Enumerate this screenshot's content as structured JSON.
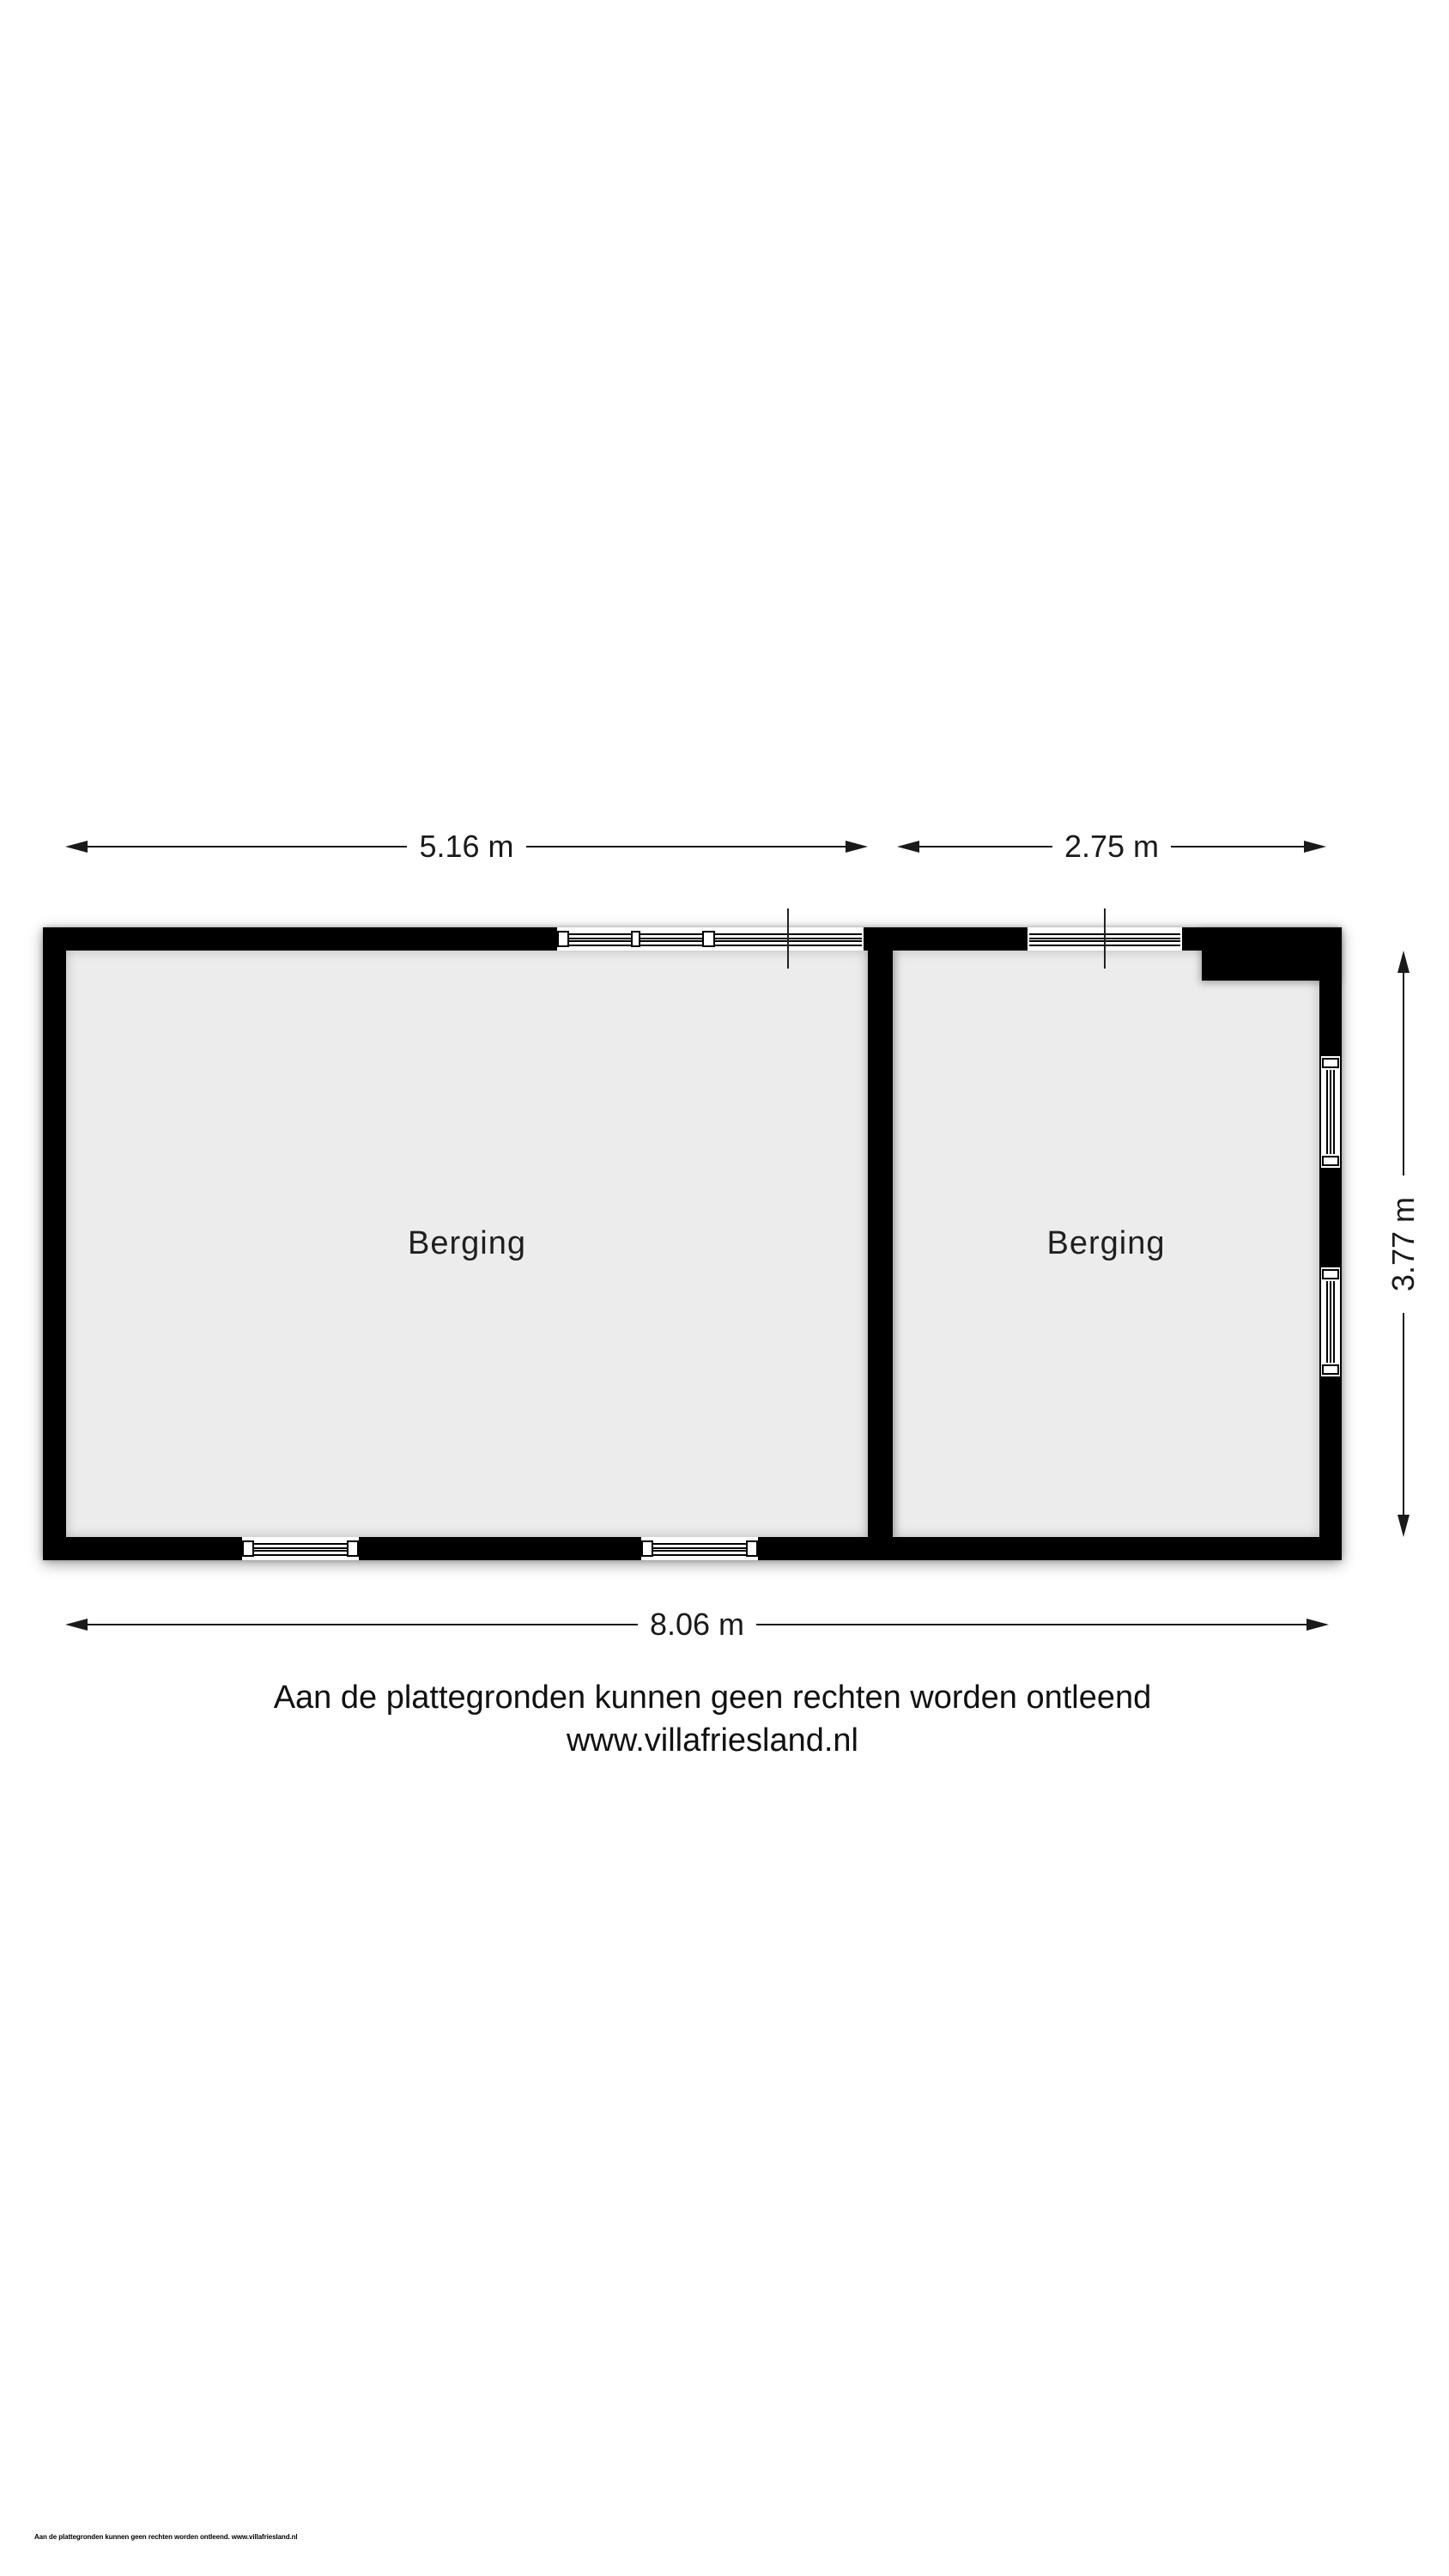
{
  "floorplan": {
    "rooms": [
      {
        "label": "Berging"
      },
      {
        "label": "Berging"
      }
    ],
    "dimensions": {
      "top_left": "5.16 m",
      "top_right": "2.75 m",
      "bottom": "8.06 m",
      "right": "3.77 m"
    }
  },
  "footer": {
    "disclaimer": "Aan de plattegronden kunnen geen rechten worden ontleend",
    "website": "www.villafriesland.nl"
  },
  "footnote": "Aan de plattegronden kunnen geen rechten worden ontleend. www.villafriesland.nl",
  "colors": {
    "wall": "#000000",
    "floor": "#ececec",
    "text": "#1a1a1a",
    "background": "#ffffff"
  }
}
